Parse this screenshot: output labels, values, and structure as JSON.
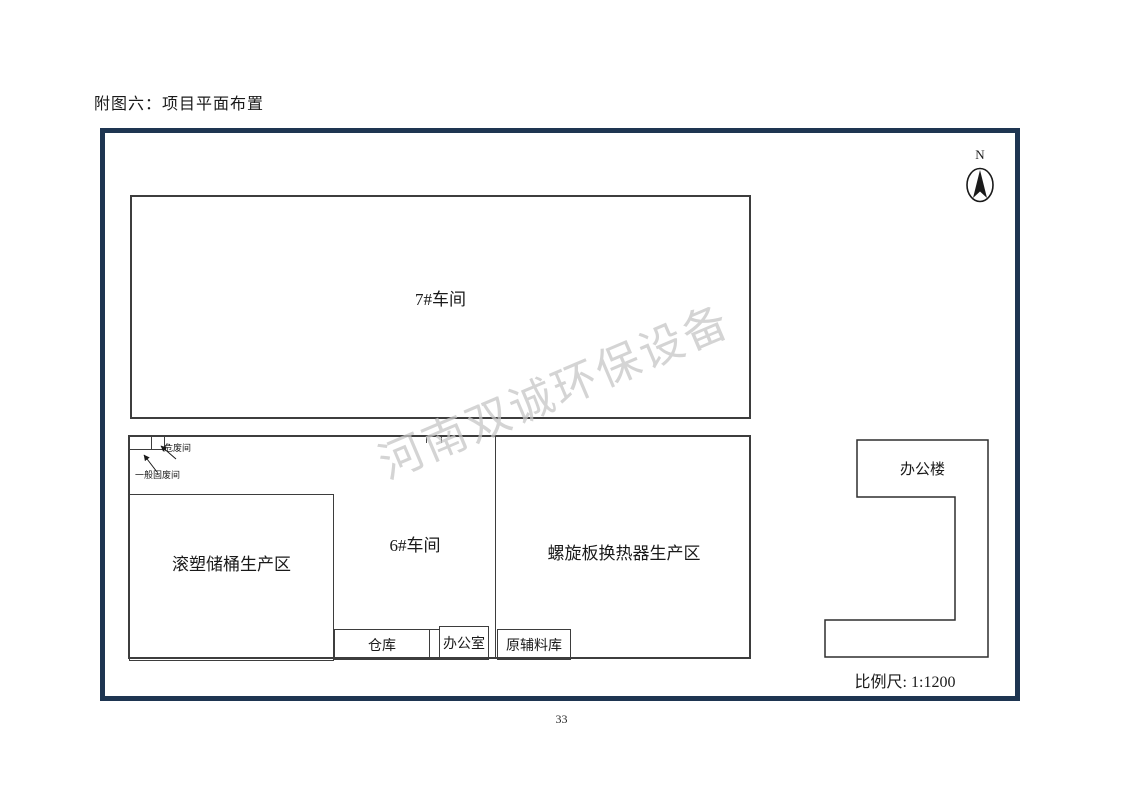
{
  "page": {
    "title": "附图六：项目平面布置",
    "page_number": "33"
  },
  "diagram": {
    "watermark": "河南双诚环保设备",
    "compass": {
      "label": "N"
    },
    "scale": {
      "label": "比例尺: 1:1200"
    },
    "labels": {
      "workshop7": "7#车间",
      "workshop6": "6#车间",
      "rotomolding_area": "滚塑储桶生产区",
      "spiral_heat_exchanger_area": "螺旋板换热器生产区",
      "warehouse": "仓库",
      "office_room": "办公室",
      "raw_material_warehouse": "原辅料库",
      "office_building": "办公楼",
      "hazardous_waste_room": "危废间",
      "general_solid_waste_room": "一般固废间"
    },
    "colors": {
      "frame_border": "#1e3551",
      "building_outline": "#3d3d3d",
      "watermark": "#c6c6c6"
    }
  }
}
